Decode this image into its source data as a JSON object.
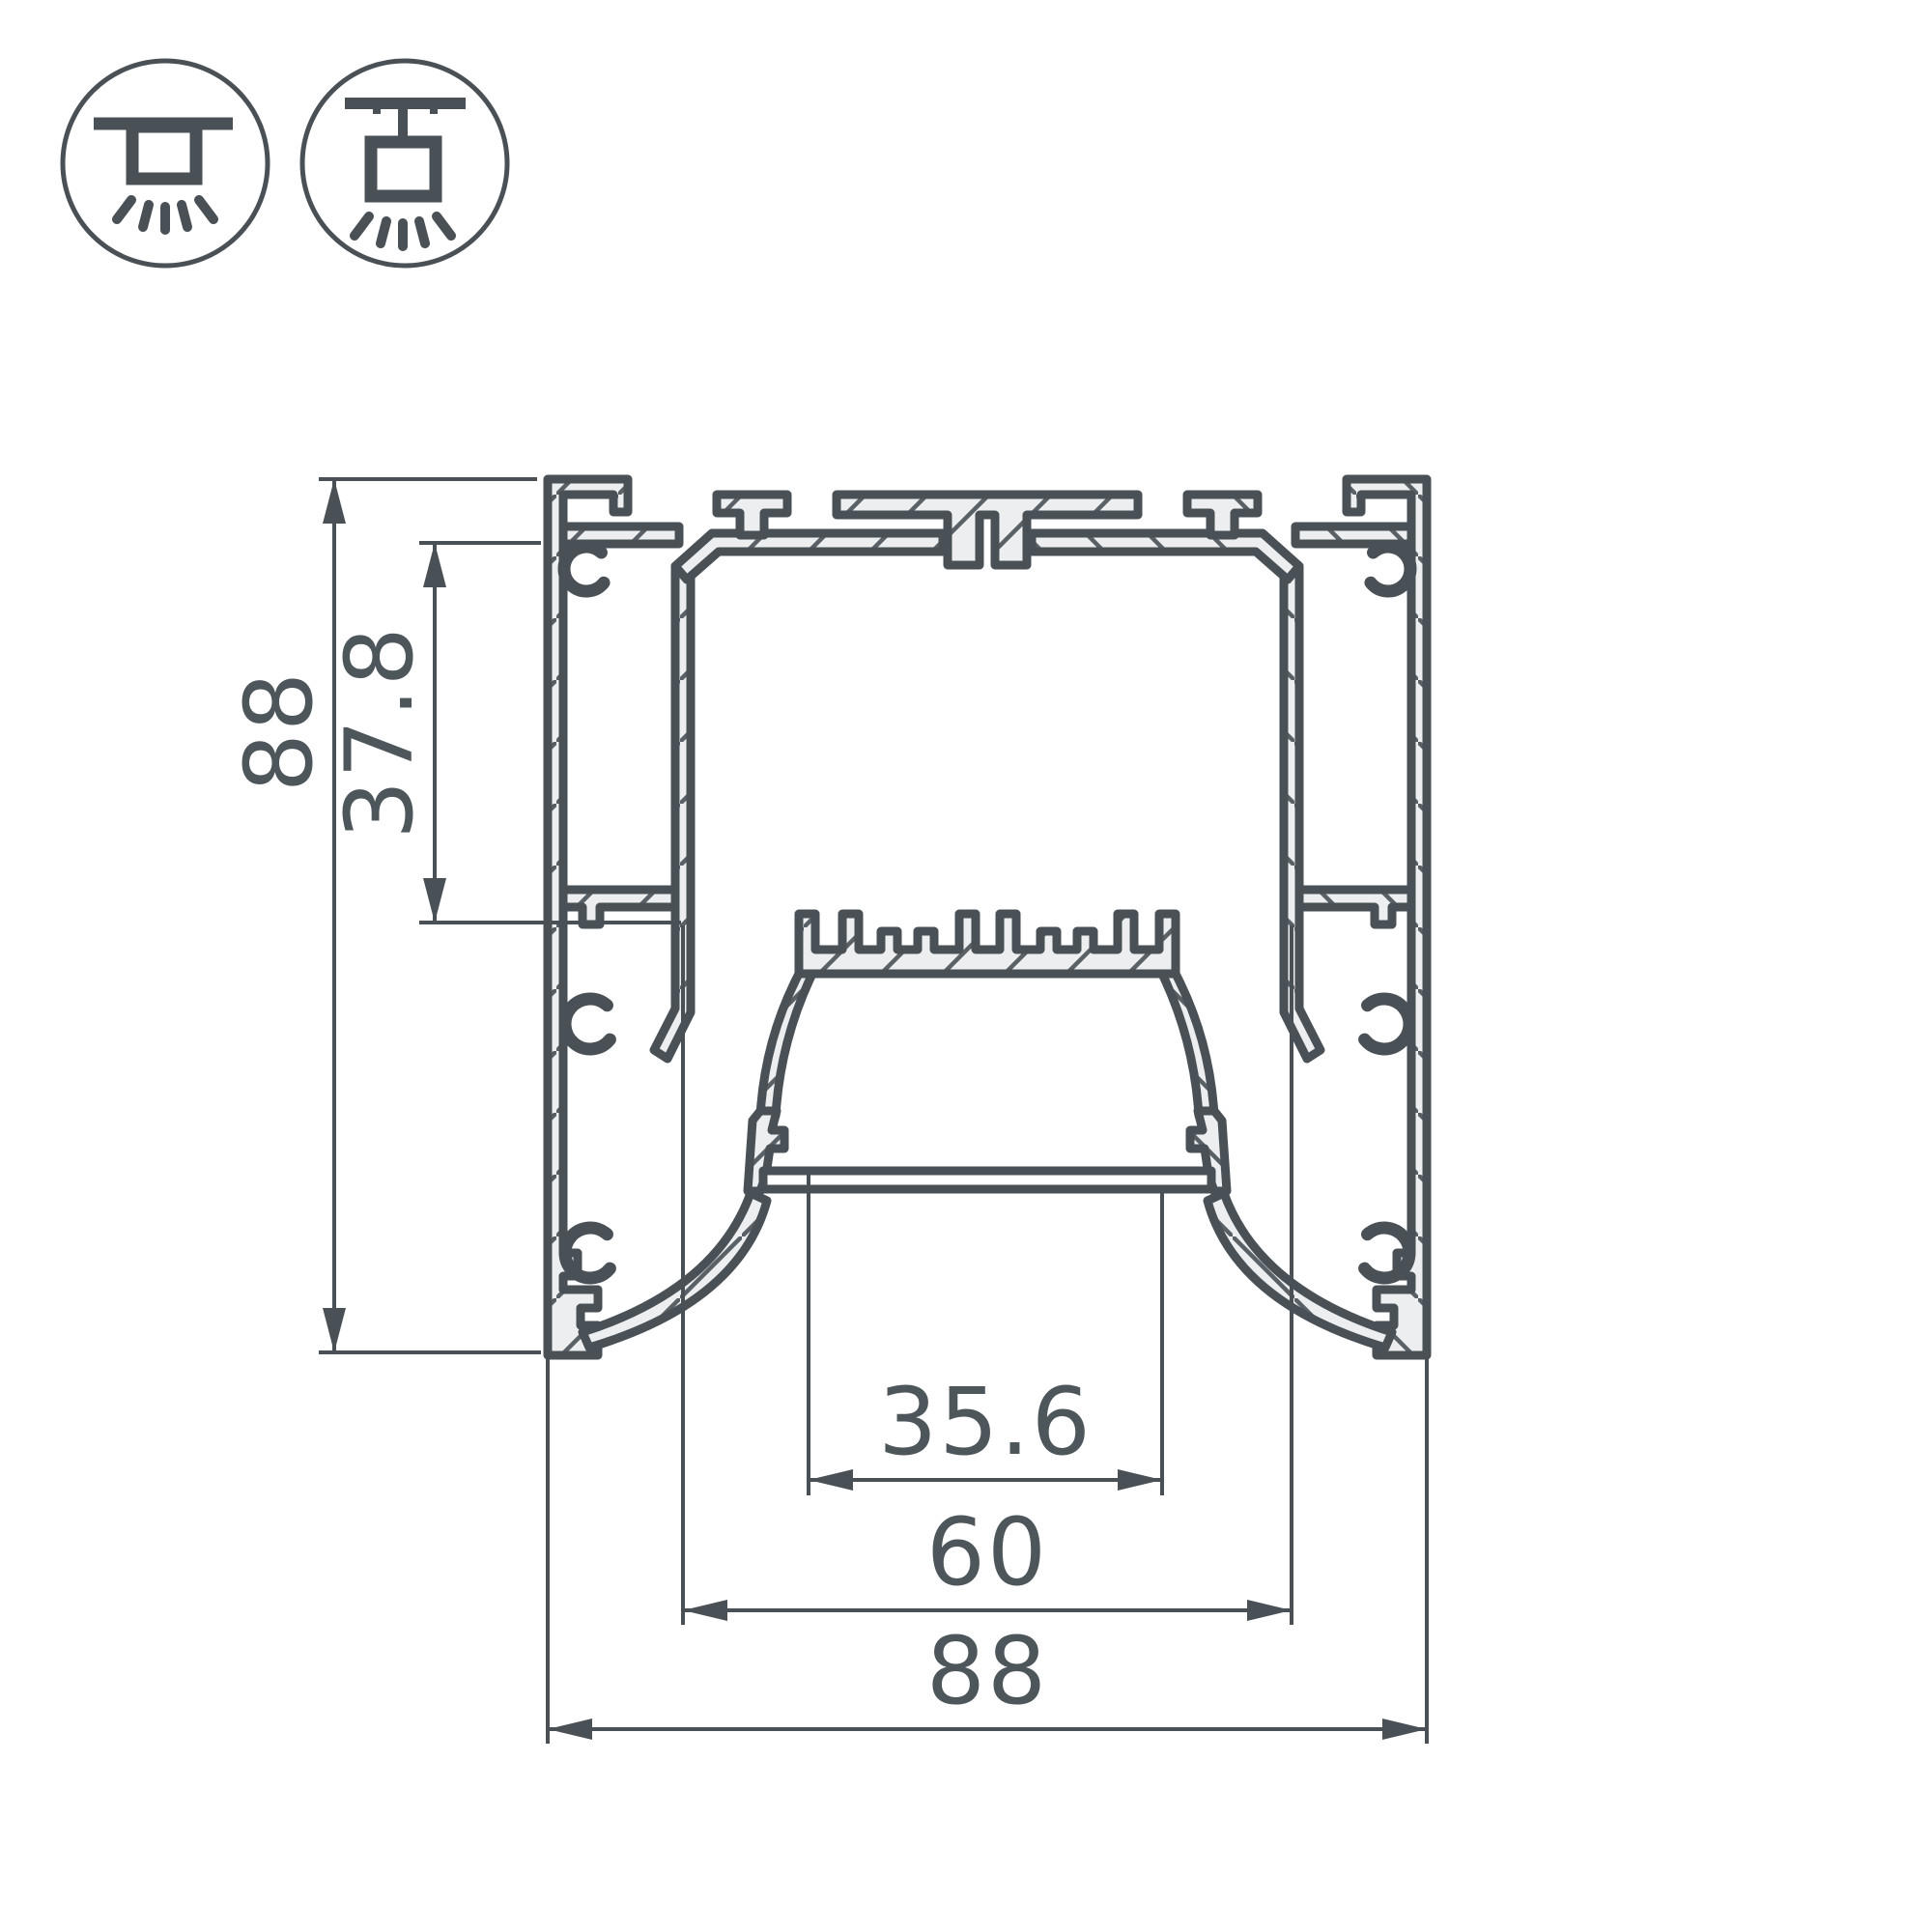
{
  "drawing": {
    "type": "technical-cross-section",
    "title": "LED profile cross-section with dimensions",
    "mount_icons": {
      "first": "surface-ceiling-mount",
      "second": "pendant-suspension-mount"
    },
    "dimensions": {
      "overall_height": "88",
      "top_channel_depth": "37.8",
      "lens_window_width": "35.6",
      "inner_chamber_width": "60",
      "overall_width": "88"
    },
    "colors": {
      "line": "#4a5156",
      "aluminum_fill": "#eceeef",
      "background": "#ffffff"
    }
  }
}
